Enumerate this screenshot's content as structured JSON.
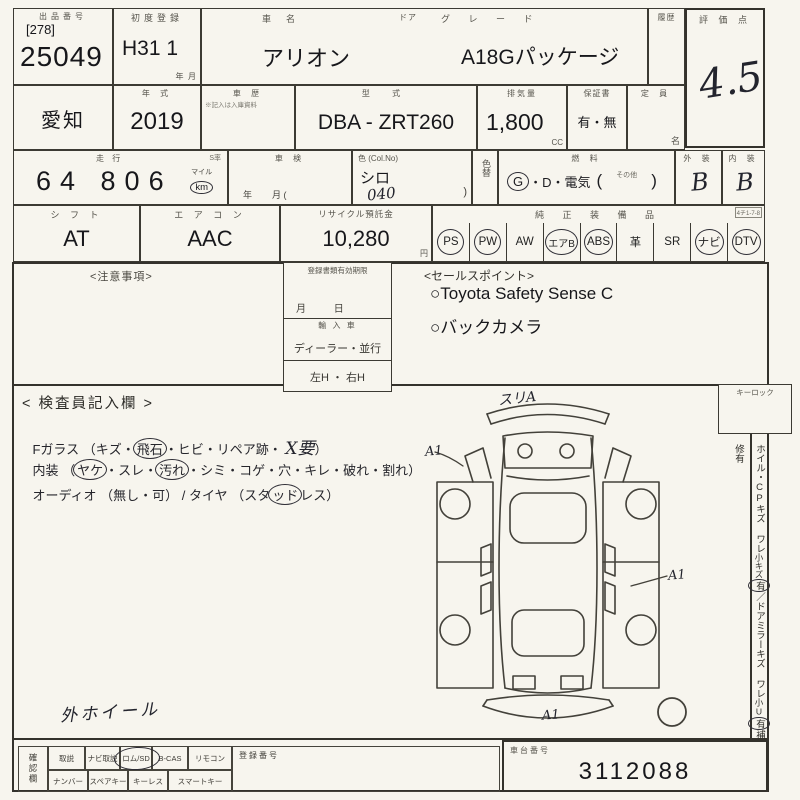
{
  "t": {
    "lot_label": "出品番号",
    "lot_bracket": "[278]",
    "lot_no": "25049",
    "reg_label": "初度登録",
    "reg_val": "H31 1",
    "reg_unit": "年  月",
    "name_label": "車　名",
    "name_val": "アリオン",
    "door_label": "ドア",
    "grade_label": "グ レ ー ド",
    "grade_val": "A18Gパッケージ",
    "hist_label": "履歴",
    "score_label": "評 価 点",
    "score_val": "4.5",
    "pref_val": "愛知",
    "year_label": "年  式",
    "year_val": "2019",
    "chist_label": "車  歴",
    "chist_note": "※記入は入庫資料",
    "model_label": "型  式",
    "model_val": "DBA - ZRT260",
    "disp_label": "排気量",
    "disp_val": "1,800",
    "disp_unit": "CC",
    "warr_label": "保証書",
    "warr_val": "有・無",
    "cap_label": "定  員",
    "cap_unit": "名",
    "mile_label": "走  行",
    "mile_s": "S率",
    "mile_val": "64 806",
    "mile_u1": "マイル",
    "mile_u2": "km",
    "shaken_label": "車  検",
    "shaken_unit": "年        月 (",
    "color_label": "色 (Col.No)",
    "color_val": "シロ",
    "color_code": "040",
    "color_paren": ")",
    "cchg_label": "色替",
    "fuel_label": "燃  料",
    "fuel_g": "G",
    "fuel_rest": "・D・電気",
    "fuel_po": "(",
    "fuel_other": "その他",
    "fuel_pc": ")",
    "ext_label": "外  装",
    "ext_val": "B",
    "int_label": "内  装",
    "int_val": "B",
    "shift_label": "シ フ ト",
    "shift_val": "AT",
    "ac_label": "エ ア コ ン",
    "ac_val": "AAC",
    "rec_label": "リサイクル預託金",
    "rec_val": "10,280",
    "rec_unit": "円",
    "equip_label": "純 正 装 備 品",
    "equip_code": "4チ1-7-8",
    "equip": [
      {
        "label": "PS",
        "on": "true"
      },
      {
        "label": "PW",
        "on": "true"
      },
      {
        "label": "AW",
        "on": "false"
      },
      {
        "label": "エアB",
        "on": "true"
      },
      {
        "label": "ABS",
        "on": "true"
      },
      {
        "label": "革",
        "on": "false"
      },
      {
        "label": "SR",
        "on": "false"
      },
      {
        "label": "ナビ",
        "on": "true"
      },
      {
        "label": "DTV",
        "on": "true"
      }
    ]
  },
  "m": {
    "notes": "<注意事項>",
    "docs_label": "登録書類有効期限",
    "docs_unit": "月          日",
    "imp_label": "輸 入 車",
    "imp_val": "ディーラー・並行",
    "handle": "左H ・ 右H",
    "sales": "<セールスポイント>",
    "sp1": "○Toyota Safety Sense C",
    "sp2": "○バックカメラ"
  },
  "i": {
    "title": "< 検査員記入欄 >",
    "g1": "Fガラス （キズ・",
    "g2": "飛石",
    "g3": "・ヒビ・リペア跡・ ",
    "g4": "X要",
    "g5": "）",
    "n1": "内装 （",
    "n2": "ヤケ",
    "n3": "・スレ・",
    "n4": "汚れ",
    "n5": "・シミ・コゲ・穴・キレ・破れ・割れ）",
    "a1": "オーディオ （無し・可） / タイヤ （スタ",
    "a2": "ッド",
    "a3": "レス）",
    "wheel": "外ホイール",
    "keylock": "キーロック",
    "sn1": "ホイル・CPキズ ワレ",
    "sn2": "小キズ",
    "sn2u": "有",
    "sn3": "／ドアミラーキズ ワレ",
    "sn4": "小U",
    "sn4u": "有",
    "sn5": "補修有",
    "mk_top": "スリA",
    "mk_left": "A1",
    "mk_right": "A1",
    "mk_bottom": "A1"
  },
  "b": {
    "confirm": "確認欄",
    "r1": [
      "取説",
      "ナビ取説",
      "ロム/SD",
      "B-CAS",
      "リモコン"
    ],
    "r2": [
      "ナンバー",
      "スペアキー",
      "キーレス",
      "スマートキー"
    ],
    "regno": "登録番号",
    "chassis_label": "車台番号",
    "chassis_val": "3112088"
  }
}
